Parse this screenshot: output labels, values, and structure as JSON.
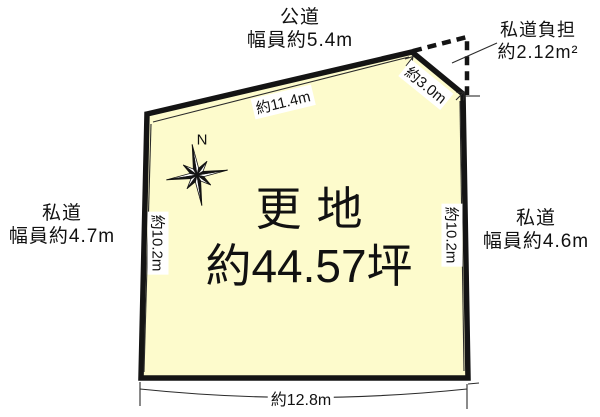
{
  "diagram": {
    "site": {
      "label_line1": "更地",
      "label_line2": "約44.57坪"
    },
    "north_label": "N",
    "roads": {
      "top": {
        "line1": "公道",
        "line2": "幅員約5.4m"
      },
      "left": {
        "line1": "私道",
        "line2": "幅員約4.7m"
      },
      "right": {
        "line1": "私道",
        "line2": "幅員約4.6m"
      },
      "burden": {
        "line1": "私道負担",
        "line2": "約2.12m²"
      }
    },
    "dimensions": {
      "top": "約11.4m",
      "diagonal": "約3.0m",
      "left": "約10.2m",
      "right": "約10.2m",
      "bottom": "約12.8m"
    },
    "colors": {
      "plot_fill": "#FDFBCC",
      "outline": "#141414",
      "thin_line": "#2b2b2b"
    }
  }
}
